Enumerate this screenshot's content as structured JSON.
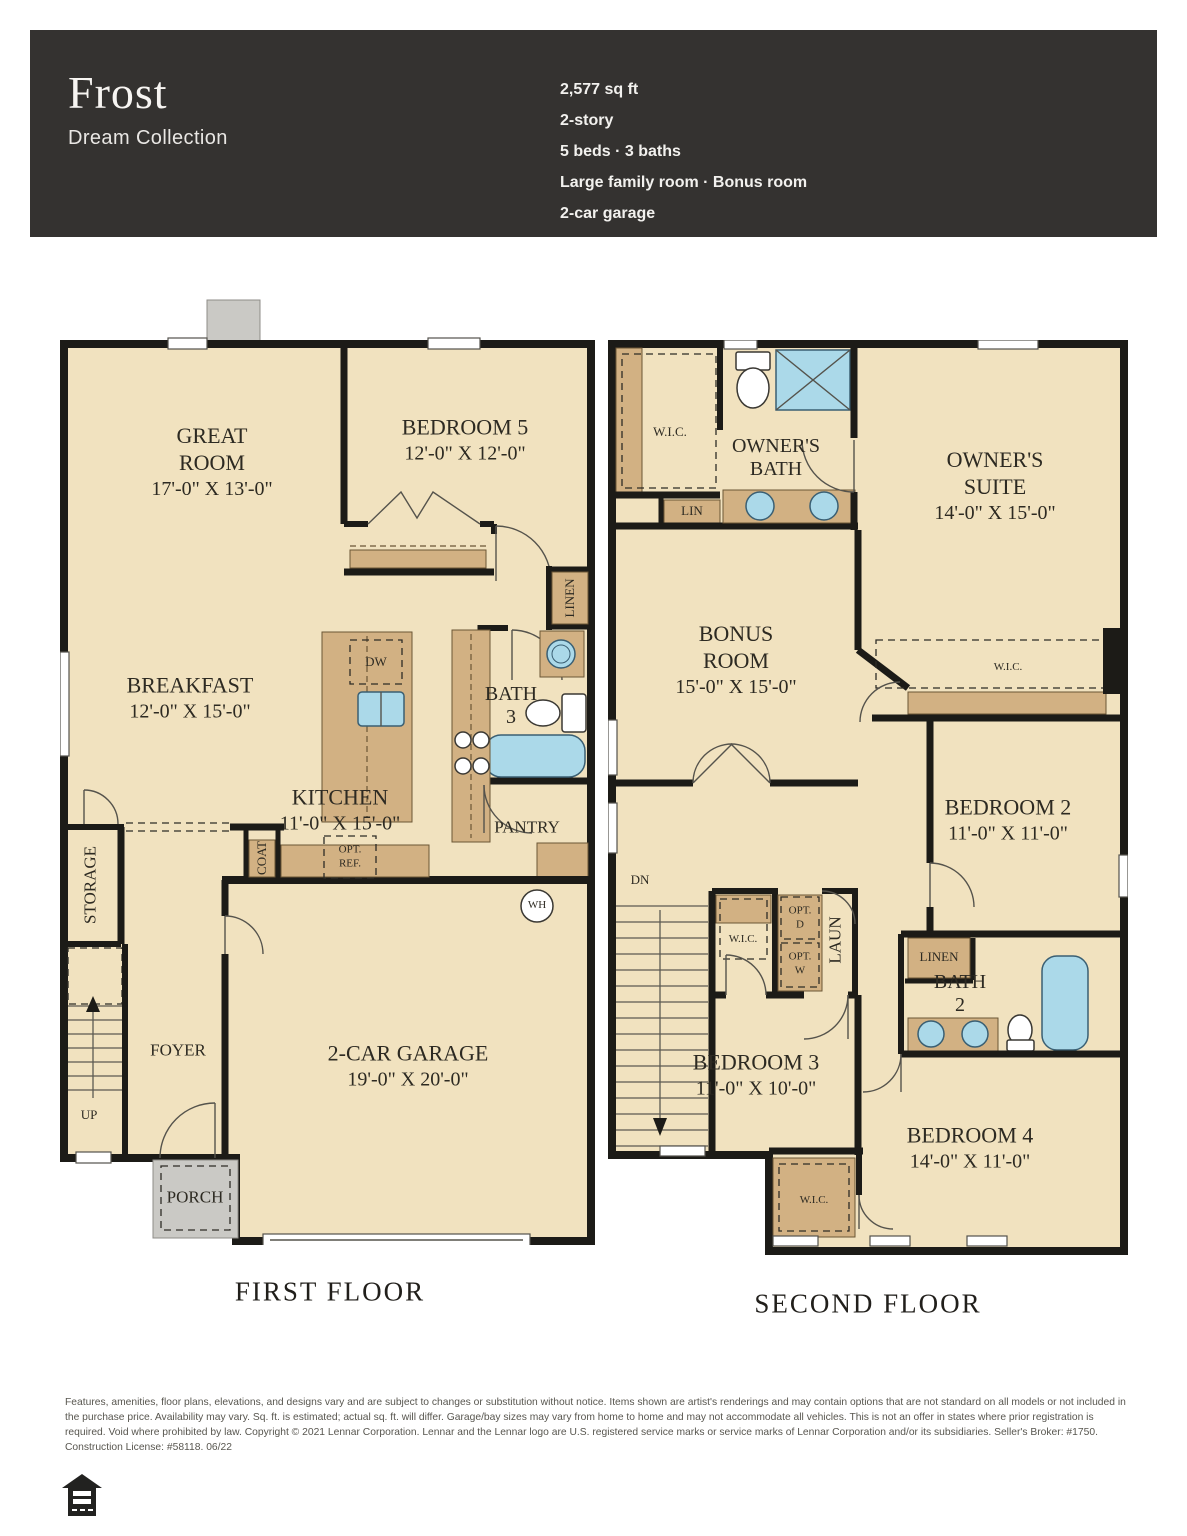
{
  "header": {
    "plan_name": "Frost",
    "collection": "Dream Collection",
    "specs": [
      "2,577 sq ft",
      "2-story",
      "5 beds · 3 baths",
      "Large family room · Bonus room",
      "2-car garage"
    ]
  },
  "ff": {
    "caption": "FIRST FLOOR",
    "great_room_name": "GREAT ROOM",
    "great_room_dims": "17'-0\" X 13'-0\"",
    "bedroom5_name": "BEDROOM 5",
    "bedroom5_dims": "12'-0\" X 12'-0\"",
    "breakfast_name": "BREAKFAST",
    "breakfast_dims": "12'-0\" X 15'-0\"",
    "kitchen_name": "KITCHEN",
    "kitchen_dims": "11'-0\" X 15'-0\"",
    "garage_name": "2-CAR GARAGE",
    "garage_dims": "19'-0\" X 20'-0\"",
    "bath3_l1": "BATH",
    "bath3_l2": "3",
    "pantry": "PANTRY",
    "linen": "LINEN",
    "coat": "COAT",
    "storage": "STORAGE",
    "foyer": "FOYER",
    "up": "UP",
    "porch": "PORCH",
    "dw": "DW",
    "wh": "WH",
    "opt_ref_l1": "OPT.",
    "opt_ref_l2": "REF."
  },
  "sf": {
    "caption": "SECOND FLOOR",
    "wic": "W.I.C.",
    "lin": "LIN",
    "linen": "LINEN",
    "laun": "LAUN",
    "dn": "DN",
    "owners_bath_l1": "OWNER'S",
    "owners_bath_l2": "BATH",
    "suite_l1": "OWNER'S",
    "suite_l2": "SUITE",
    "suite_dims": "14'-0\" X 15'-0\"",
    "bonus_l1": "BONUS",
    "bonus_l2": "ROOM",
    "bonus_dims": "15'-0\" X 15'-0\"",
    "bedroom2_name": "BEDROOM 2",
    "bedroom2_dims": "11'-0\" X 11'-0\"",
    "bedroom3_name": "BEDROOM 3",
    "bedroom3_dims": "11'-0\" X 10'-0\"",
    "bedroom4_name": "BEDROOM 4",
    "bedroom4_dims": "14'-0\" X 11'-0\"",
    "bath2_l1": "BATH",
    "bath2_l2": "2",
    "opt_d_l1": "OPT.",
    "opt_d_l2": "D",
    "opt_w_l1": "OPT.",
    "opt_w_l2": "W"
  },
  "disclaimer": "Features, amenities, floor plans, elevations, and designs vary and are subject to changes or substitution without notice. Items shown are artist's renderings and may contain options that are not standard on all models or not included in the purchase price. Availability may vary. Sq. ft. is estimated; actual sq. ft. will differ. Garage/bay sizes may vary from home to home and may not accommodate all vehicles. This is not an offer in states where prior registration is required. Void where prohibited by law. Copyright © 2021 Lennar Corporation. Lennar and the Lennar logo are U.S. registered service marks or service marks of Lennar Corporation and/or its subsidiaries. Seller's Broker: #1750. Construction License: #58118. 06/22",
  "colors": {
    "header_bg": "#343230",
    "floor_fill": "#f1e2bf",
    "cabinet_fill": "#d2b183",
    "wall": "#1c1b17",
    "porch_gray": "#cac9c5",
    "fixture_blue": "#abd9e9"
  }
}
